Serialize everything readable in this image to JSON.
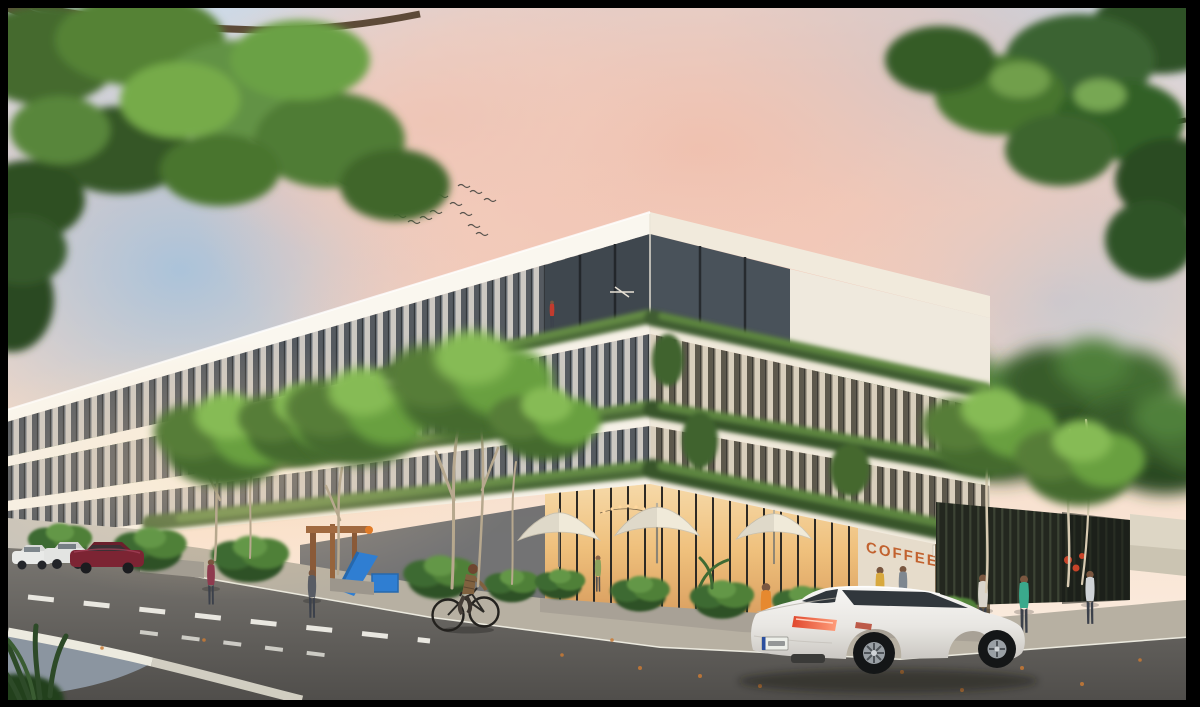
{
  "meta": {
    "kind": "architectural-rendering-photo",
    "canvas": {
      "width": 1200,
      "height": 707
    },
    "frame_color": "#000000"
  },
  "scene": {
    "description": "Photorealistic dusk rendering of a modern four-storey apartment building with plant-covered balconies and a corner coffee shop with white patio umbrellas; street trees frame the view, pedestrians and a cyclist pass by, cars are parked along the left street and a white coupe drives through the foreground under a pink sunset sky.",
    "signage": {
      "coffee_sign_text": "COFFEE",
      "coffee_sign_color": "#c2622f"
    },
    "sky": {
      "time_of_day": "sunset",
      "palette": [
        "#c3d4e4",
        "#f2c4b4",
        "#f8e0d0",
        "#9fc0dd"
      ],
      "birds_count": 14
    },
    "building": {
      "storeys": 4,
      "facade_color": "#f6f1e7",
      "glass_color": "#6e747b",
      "balcony_plants_color": "#4c6a38",
      "ground_floor_use": "coffee shop",
      "interior_light_color": "#f0c183",
      "umbrella_count": 3,
      "umbrella_color": "#f0ead9",
      "string_lights_color": "#ffd79e"
    },
    "street": {
      "asphalt_color": "#5d5b58",
      "sidewalk_color": "#b7b0a2",
      "curb_color": "#eceadf",
      "lane_marking_color": "#e9e7e0",
      "traffic_island_color": "#8b95a0",
      "fallen_leaves_color": "#c97a35"
    },
    "vehicles": {
      "foreground_car": {
        "type": "coupe",
        "color": "#f1efec",
        "view": "rear three-quarter",
        "taillight_color": "#e0482e",
        "license_plate_color": "#edefe9",
        "license_plate_legible": false
      },
      "parked_cars": [
        {
          "type": "car",
          "color": "#e9eae8"
        },
        {
          "type": "car",
          "color": "#e3e4e2"
        },
        {
          "type": "sedan",
          "color": "#7c2433"
        }
      ]
    },
    "people": {
      "pedestrians_count": 8,
      "cyclists_count": 1,
      "balcony_figures_count": 1
    },
    "playground": {
      "slide_color": "#2f7ed2",
      "frame_color": "#8a5a38"
    },
    "vegetation": {
      "street_tree_colors": [
        "#456b2f",
        "#69a041",
        "#86bb54"
      ],
      "shadow_green": "#2e5128",
      "palm_accent_color": "#2d4a28",
      "overhanging_branch_color": "#5f4c39"
    },
    "site": {
      "fence_color": "#23271f",
      "fence_slat_color": "#3c4334",
      "wall_color": "#ddd6c5",
      "flower_accent_color": "#d9472b"
    }
  }
}
